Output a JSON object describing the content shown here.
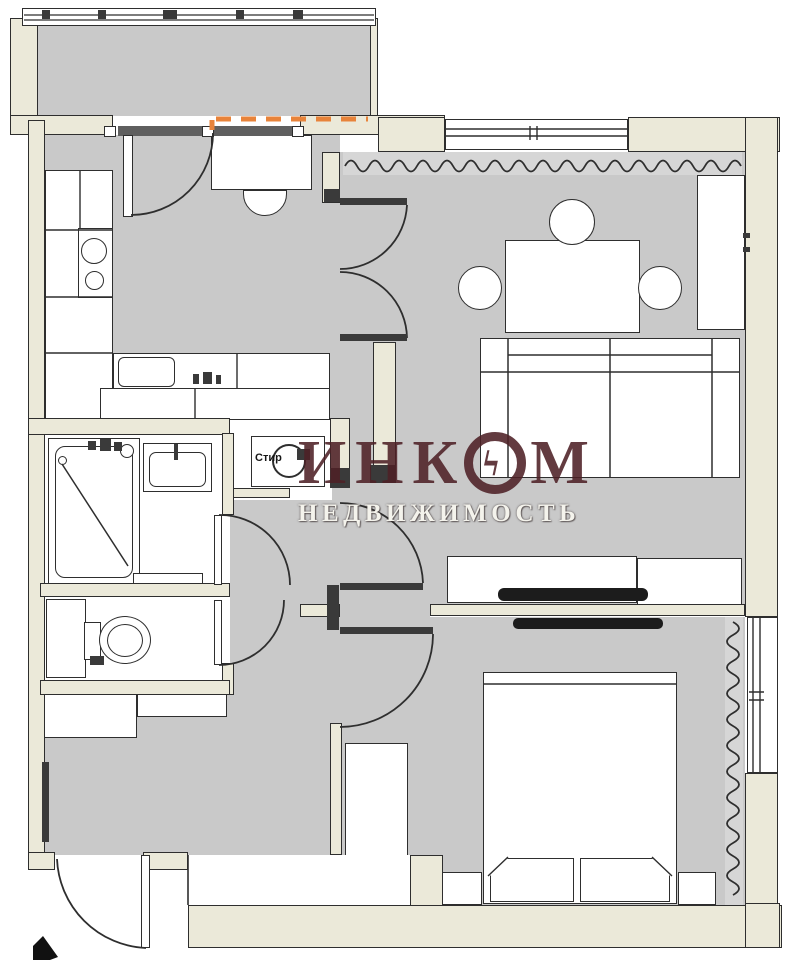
{
  "watermark": {
    "brand_prefix": "ИНК",
    "brand_suffix": "М",
    "bolt_glyph": "ϟ",
    "subtitle": "НЕДВИЖИМОСТЬ",
    "brand_color": "#4d2026",
    "subtitle_color": "#f4f3ec"
  },
  "labels": {
    "washing_machine": "Стир"
  },
  "colors": {
    "wall_fill": "#ebe9d9",
    "floor_fill": "#c9c9c9",
    "line": "#2e2e2e",
    "accent_dashes": "#e8833a",
    "radiator_band": "#d6d6d6",
    "sill": "#5f5f5f"
  }
}
